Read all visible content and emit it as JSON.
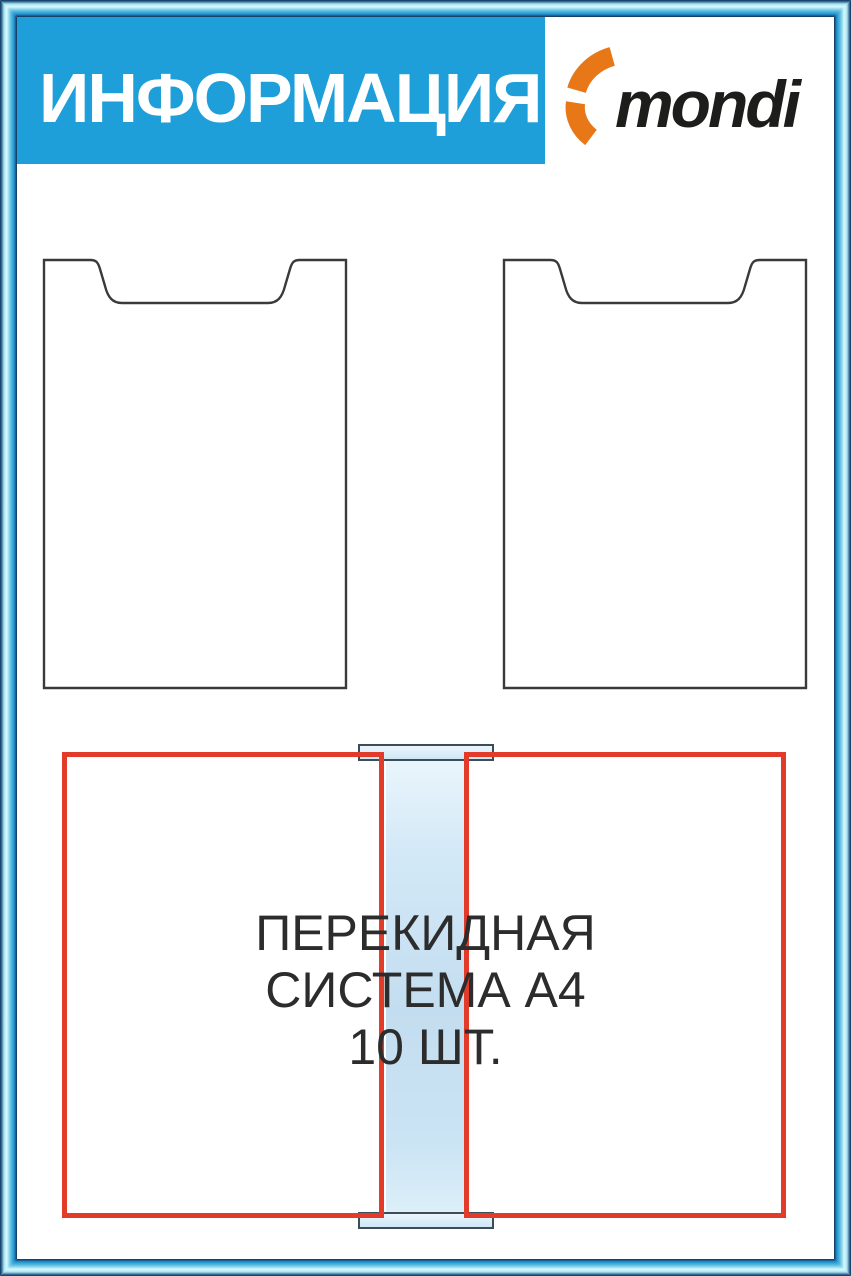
{
  "header": {
    "title": "ИНФОРМАЦИЯ",
    "logo": {
      "text": "mondi",
      "icon": "mondi-flame-icon"
    }
  },
  "pockets": {
    "count": 2,
    "type": "A4"
  },
  "flip_system": {
    "line1": "ПЕРЕКИДНАЯ",
    "line2": "СИСТЕМА А4",
    "line3": "10 ШТ."
  },
  "colors": {
    "banner_blue": "#1E9FDA",
    "frame_light": "#A9E6F4",
    "frame_mid": "#2D9FD6",
    "frame_dark": "#14395E",
    "red_outline": "#E23B2A",
    "rail_blue": "#C3DDF0",
    "logo_orange": "#E87817",
    "logo_text_color": "#1D1D1B",
    "text_color": "#2C2C2C"
  }
}
